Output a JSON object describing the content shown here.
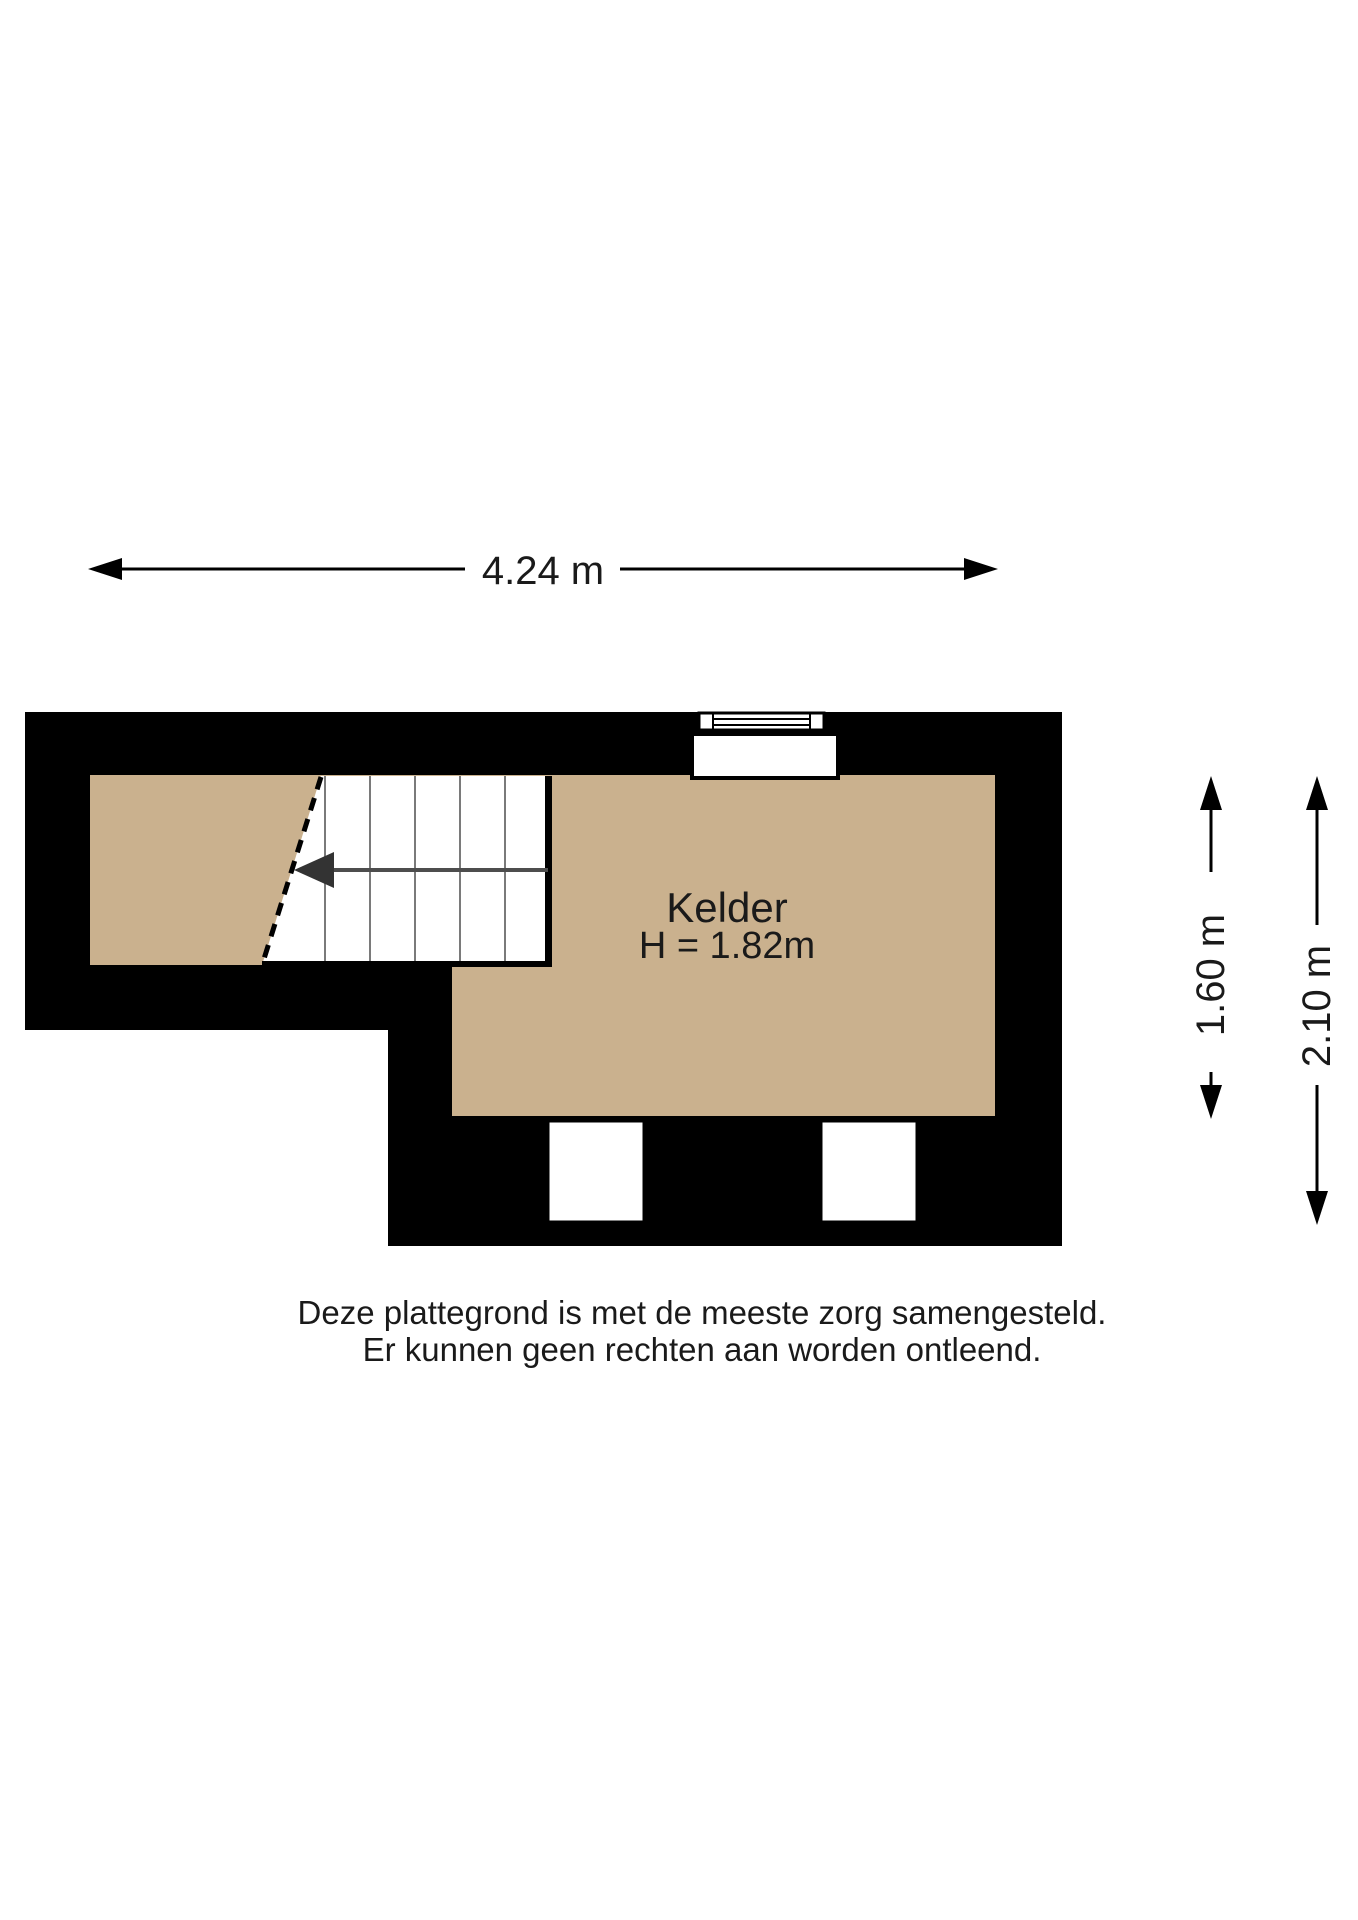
{
  "colors": {
    "wall": "#000000",
    "floor": "#CAB18E",
    "stair_tread": "#7a7a7a",
    "stair_guide": "#4d4d4d",
    "stair_arrow": "#333333"
  },
  "dimensions": {
    "total_width": "4.24 m",
    "inner_height": "1.60 m",
    "outer_height": "2.10 m"
  },
  "room": {
    "name": "Kelder",
    "ceiling_height": "H = 1.82m"
  },
  "disclaimer": {
    "line1": "Deze plattegrond is met de meeste zorg samengesteld.",
    "line2": "Er kunnen geen rechten aan worden ontleend."
  }
}
